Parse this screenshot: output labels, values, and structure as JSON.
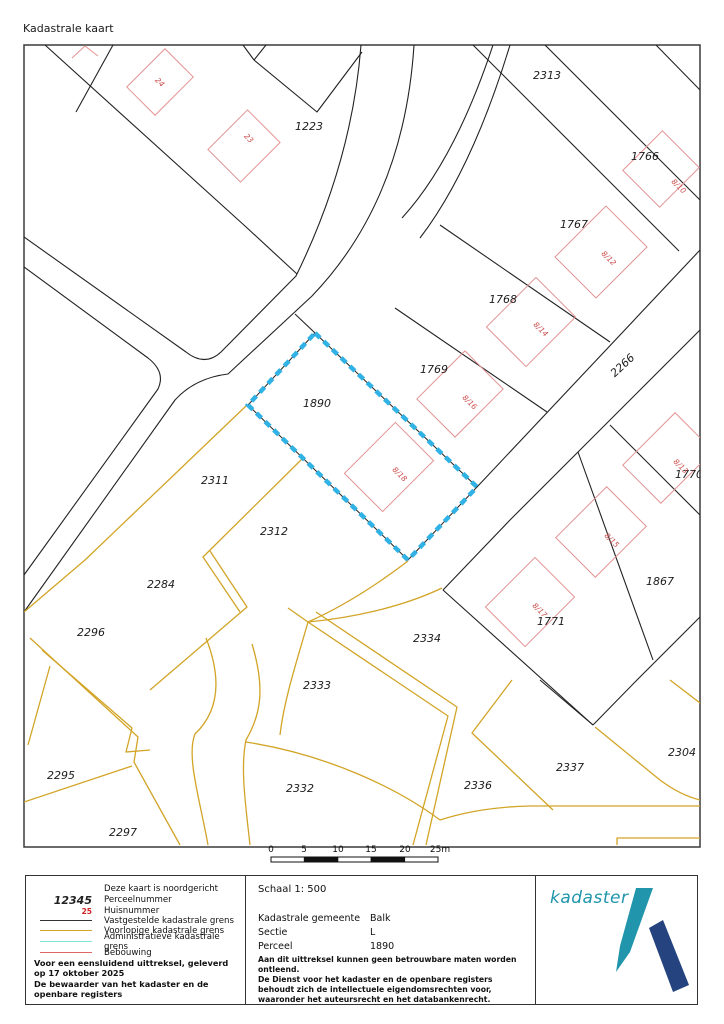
{
  "title": "Kadastrale kaart",
  "map": {
    "selected_parcel": "1890",
    "parcel_labels": [
      {
        "text": "1223",
        "x": 309,
        "y": 130
      },
      {
        "text": "2313",
        "x": 547,
        "y": 79
      },
      {
        "text": "1766",
        "x": 645,
        "y": 160
      },
      {
        "text": "1767",
        "x": 574,
        "y": 228
      },
      {
        "text": "1768",
        "x": 503,
        "y": 303
      },
      {
        "text": "1769",
        "x": 434,
        "y": 373
      },
      {
        "text": "1890",
        "x": 317,
        "y": 407
      },
      {
        "text": "2311",
        "x": 215,
        "y": 484
      },
      {
        "text": "2312",
        "x": 274,
        "y": 535
      },
      {
        "text": "2284",
        "x": 161,
        "y": 588
      },
      {
        "text": "2296",
        "x": 91,
        "y": 636
      },
      {
        "text": "2295",
        "x": 61,
        "y": 779
      },
      {
        "text": "2297",
        "x": 123,
        "y": 836
      },
      {
        "text": "2334",
        "x": 427,
        "y": 642
      },
      {
        "text": "2333",
        "x": 317,
        "y": 689
      },
      {
        "text": "2332",
        "x": 300,
        "y": 792
      },
      {
        "text": "2336",
        "x": 478,
        "y": 789
      },
      {
        "text": "1771",
        "x": 551,
        "y": 625
      },
      {
        "text": "2337",
        "x": 570,
        "y": 771
      },
      {
        "text": "2304",
        "x": 682,
        "y": 756
      },
      {
        "text": "1867",
        "x": 660,
        "y": 585
      },
      {
        "text": "1770",
        "x": 689,
        "y": 478
      },
      {
        "text": "2266",
        "x": 625,
        "y": 368,
        "rot": -43
      }
    ],
    "building_labels": [
      {
        "text": "24",
        "x": 158,
        "y": 84,
        "rot": 45
      },
      {
        "text": "23",
        "x": 247,
        "y": 140,
        "rot": 45
      },
      {
        "text": "8/10",
        "x": 677,
        "y": 188,
        "rot": 45
      },
      {
        "text": "8/12",
        "x": 607,
        "y": 260,
        "rot": 45
      },
      {
        "text": "8/14",
        "x": 539,
        "y": 331,
        "rot": 45
      },
      {
        "text": "8/16",
        "x": 468,
        "y": 404,
        "rot": 45
      },
      {
        "text": "8/18",
        "x": 398,
        "y": 476,
        "rot": 45
      },
      {
        "text": "8/13",
        "x": 679,
        "y": 468,
        "rot": 45
      },
      {
        "text": "8/15",
        "x": 610,
        "y": 542,
        "rot": 45
      },
      {
        "text": "8/17",
        "x": 538,
        "y": 612,
        "rot": 45
      }
    ],
    "colors": {
      "selected_parcel_boundary": "#31b2e5",
      "established_boundary": "#222222",
      "provisional_boundary": "#d2a427",
      "administrative_boundary": "#7fe5d5",
      "building_outline": "#e39393",
      "building_label": "#c94848"
    }
  },
  "scale_bar": {
    "labels": [
      "0",
      "5",
      "10",
      "15",
      "20",
      "25m"
    ]
  },
  "legend": {
    "north_note": "Deze kaart is noordgericht",
    "items": [
      {
        "sample": "12345",
        "label": "Perceelnummer"
      },
      {
        "sample": "25",
        "label": "Huisnummer"
      },
      {
        "sample": "",
        "label": "Vastgestelde kadastrale grens"
      },
      {
        "sample": "",
        "label": "Voorlopige kadastrale grens"
      },
      {
        "sample": "",
        "label": "Administratieve kadastrale grens"
      },
      {
        "sample": "",
        "label": "Bebouwing"
      }
    ],
    "footer_line1": "Voor een eensluidend uittreksel, geleverd op 17 oktober 2025",
    "footer_line2": "De bewaarder van het kadaster en de openbare registers"
  },
  "details": {
    "scale_label": "Schaal 1: 500",
    "rows": [
      {
        "label": "Kadastrale gemeente",
        "value": "Balk"
      },
      {
        "label": "Sectie",
        "value": "L"
      },
      {
        "label": "Perceel",
        "value": "1890"
      }
    ],
    "disclaimer1": "Aan dit uittreksel kunnen geen betrouwbare maten worden ontleend.",
    "disclaimer2": "De Dienst voor het kadaster en de openbare registers behoudt zich de intellectuele eigendomsrechten voor, waaronder het auteursrecht en het databankenrecht."
  },
  "logo": {
    "text": "kadaster"
  }
}
